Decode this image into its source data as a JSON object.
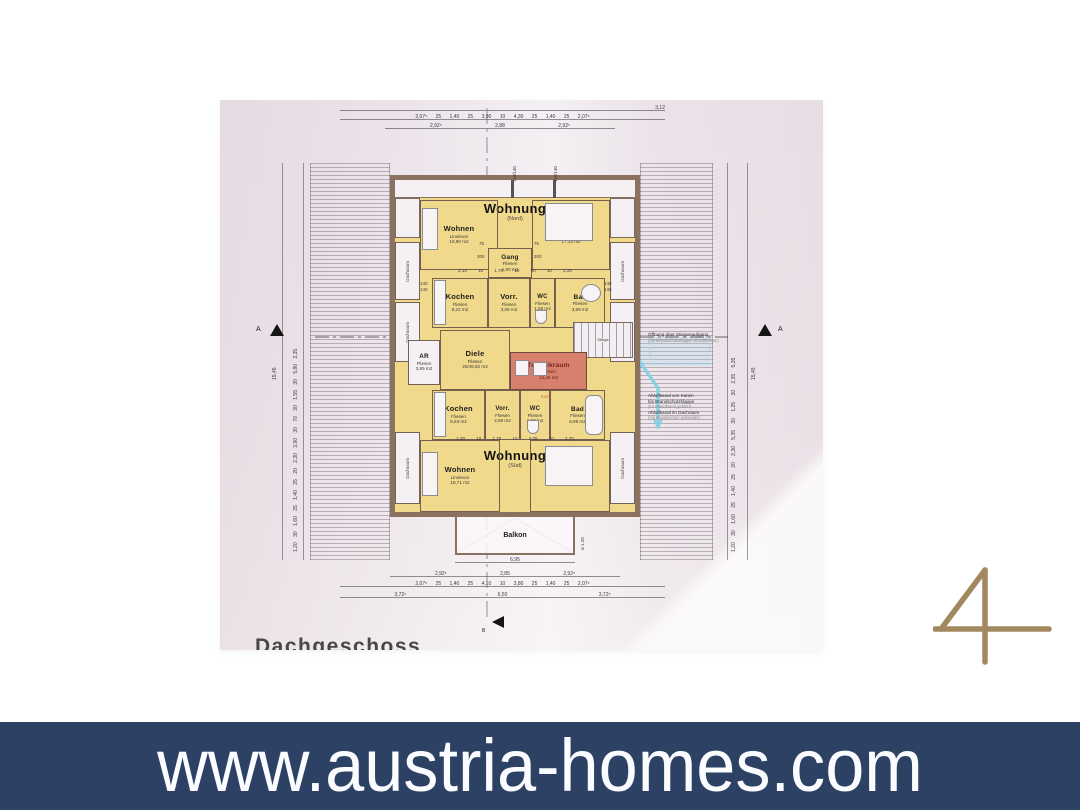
{
  "banner": {
    "url_text": "www.austria-homes.com",
    "bg": "#2d4164"
  },
  "watermark": {
    "digit": "4",
    "color": "#a2885f"
  },
  "plan": {
    "title": "Dachgeschoss",
    "markers": {
      "a": "A",
      "b": "B"
    },
    "dachraum": "Dachraum",
    "north": {
      "title": "Wohnung",
      "subtitle": "(Nord)",
      "wohnen": {
        "name": "Wohnen",
        "floor": "Linoleum",
        "area": "16,90 m2"
      },
      "schlafen": {
        "name": "Schlafen",
        "floor": "Teppich",
        "area": "17,15 m2"
      },
      "gang": {
        "name": "Gang",
        "floor": "Fliesen",
        "area": "1,90 m2"
      },
      "kochen": {
        "name": "Kochen",
        "floor": "Fliesen",
        "area": "8,22 m2"
      },
      "vorr": {
        "name": "Vorr.",
        "floor": "Fliesen",
        "area": "3,06 m2"
      },
      "wc": {
        "name": "WC",
        "floor": "Fliesen",
        "area": "1,55 m2"
      },
      "bad": {
        "name": "Bad",
        "floor": "Fliesen",
        "area": "3,99 m2"
      }
    },
    "mitte": {
      "ar": {
        "name": "AR",
        "floor": "Fliesen",
        "area": "3,85 m2"
      },
      "diele": {
        "name": "Diele",
        "floor": "Fliesen",
        "area": "20/49,82 m2"
      },
      "technik": {
        "name": "Technikraum",
        "floor": "Fliesen",
        "area": "13,46 m2"
      },
      "ventilator": "Ventilator",
      "ventilator_sub": "1,70 kW",
      "stiege": "Stiege",
      "kamin": "Kamin"
    },
    "sued": {
      "title": "Wohnung",
      "subtitle": "(Süd)",
      "kochen": {
        "name": "Kochen",
        "floor": "Fliesen",
        "area": "8,63 m2"
      },
      "vorr": {
        "name": "Vorr.",
        "floor": "Fliesen",
        "area": "2,99 m2"
      },
      "wc": {
        "name": "WC",
        "floor": "Fliesen",
        "area": "1,98 m2"
      },
      "bad": {
        "name": "Bad",
        "floor": "Fliesen",
        "area": "6,99 m2"
      },
      "wohnen": {
        "name": "Wohnen",
        "floor": "Linoleum",
        "area": "18,71 m2"
      },
      "schlafen": {
        "name": "Schlafen",
        "floor": "Teppich",
        "area": "17,01 m2"
      },
      "balkon": "Balkon"
    },
    "notes": {
      "oeffnung_line1": "Öffnung über Stiegenaufgang",
      "oeffnung_line2": "(mit Brandschutzklappe verschlossen)",
      "abluft_line1": "Abluftkanal von Kamin",
      "abluft_line2": "bis Brandschutzklappe",
      "abluft_line3": "(im Wandkanal geführt)",
      "abluft_line4": "Abluftkanal im Dachraum",
      "abluft_line5": "(mit Brandschutz verkleidet)"
    },
    "dims": {
      "top1": "3,12",
      "top2": "2,07⁵ 25 1,40 25 3,90 10 4,30 25 1,40 25 2,07⁵",
      "top3": "2,92⁵ 2,88 2,92⁵",
      "bot1": "2,92⁵ 2,85 2,92⁵",
      "bot2": "2,07⁵ 25 1,40 25 4,10 10 3,80 25 1,40 25 2,07⁵",
      "bot3": "3,72⁵ 6,50 3,72⁵",
      "left_total": "15,45",
      "left_chain": "1,20 30 1,60 25 1,40 25 20 2,30 3,90 30 70 30 1,55 30 5,80 2,35",
      "right_chain": "1,20 30 1,60 25 1,40 25 20 2,30 5,35 30 1,25 30 2,35 5,35",
      "right_total": "15,45",
      "inner_north": "2,10 10 1,70 10 90 10 2,20",
      "inner_south": "2,30 10 1,70 10 2,05 10 2,70",
      "balkon_w": "6,95",
      "balkon_r": "ø 1,20",
      "win_top1": "110/140",
      "win_top2": "115/140",
      "win_140": "140",
      "door_75": "75",
      "door_200": "200",
      "door_76": "76"
    }
  }
}
